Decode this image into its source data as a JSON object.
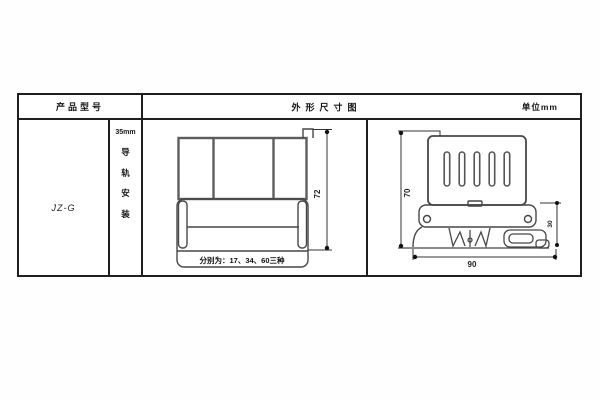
{
  "table": {
    "header": {
      "model_col": "产品型号",
      "dim_title": "外形尺寸图",
      "unit": "单位mm"
    },
    "model": "JZ-G",
    "mounting": {
      "size": "35mm",
      "chars": [
        "导",
        "轨",
        "安",
        "装"
      ]
    },
    "front_view": {
      "height": "72",
      "note": "分别为：17、34、60三种"
    },
    "side_view": {
      "height": "70",
      "width": "90",
      "base_height": "30"
    }
  }
}
